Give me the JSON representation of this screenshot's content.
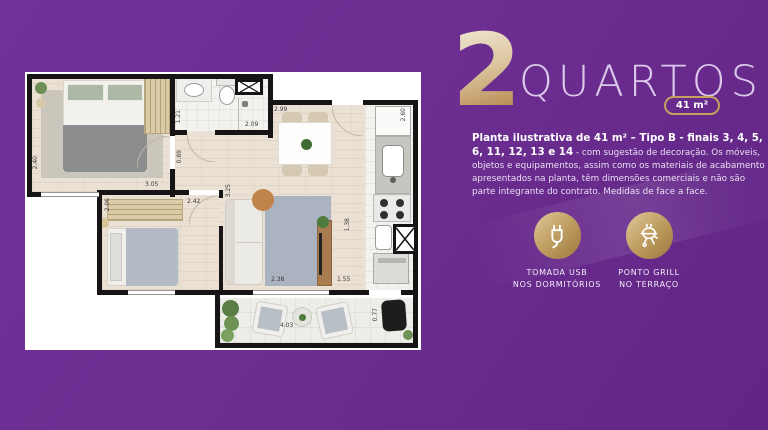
{
  "title": {
    "number": "2",
    "word": "QUARTOS",
    "area_badge": "41 m²"
  },
  "description": {
    "bold": "Planta ilustrativa de 41 m² – Tipo B - finais 3, 4, 5, 6, 11, 12, 13 e 14",
    "regular": " - com sugestão de decoração. Os móveis, objetos e equipamentos, assim como os materiais de acabamento apresentados na planta, têm dimensões comerciais e não são parte integrante do contrato. Medidas de face a face."
  },
  "features": [
    {
      "icon": "usb-plug-icon",
      "label_line1": "TOMADA USB",
      "label_line2": "NOS DORMITÓRIOS"
    },
    {
      "icon": "grill-icon",
      "label_line1": "PONTO GRILL",
      "label_line2": "NO TERRAÇO"
    }
  ],
  "colors": {
    "background": "#6c2e90",
    "gold": "#c2a165",
    "badge_border": "#c6a05e",
    "title_text": "#dcc9ea"
  },
  "floor_plan": {
    "dims": {
      "bedroom1_depth": "2.40",
      "bathroom_depth": "1.21",
      "bathroom_width": "2.09",
      "dining_width": "2.99",
      "kitchen_depth": "2.60",
      "hall_depth": "0.89",
      "bedroom2_width": "3.05",
      "bedroom2_inner_width": "2.42",
      "bedroom2_closet_width": "2.06",
      "living_depth": "3.25",
      "living_width": "2.38",
      "service_depth": "1.38",
      "service_width": "1.55",
      "terrace_width": "4.03",
      "terrace_depth": "0.77"
    }
  }
}
